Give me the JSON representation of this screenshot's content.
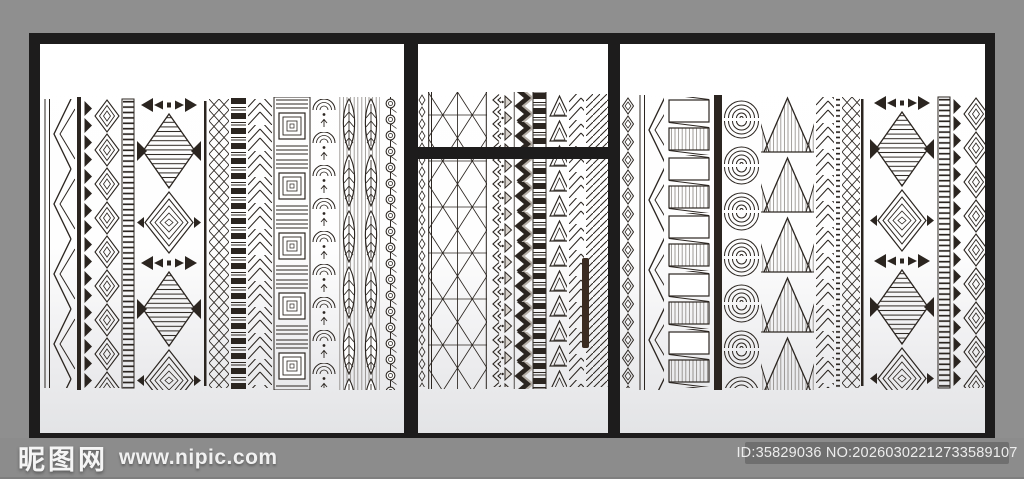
{
  "scene": {
    "description": "Stock-image preview of a black-framed three-panel glass sliding-door partition decorated with hand-drawn black and white tribal / ethnic pattern stripes, shown against a gray studio background with watermarks.",
    "panels": [
      {
        "name": "left-panel",
        "motifs": [
          "zigzag lattice",
          "sawtooth triangles",
          "nested chevron diamonds",
          "rung ladder",
          "diamond and bowtie totem",
          "crosshatch",
          "black rung ladder",
          "herringbone",
          "spiral squares",
          "scallop lace",
          "veined leaves",
          "bead chain"
        ]
      },
      {
        "name": "middle-panel",
        "motifs": [
          "diamond chain",
          "triangle net mesh",
          "chevron arrows",
          "dotted triangles",
          "bold zigzag ribbon",
          "black rung ladder",
          "hollow triangles",
          "herringbone",
          "diagonal hatch"
        ],
        "hardware": [
          "horizontal crossbar",
          "door handle"
        ]
      },
      {
        "name": "right-panel",
        "motifs": [
          "diamond chain",
          "zigzag lattice",
          "hatched rectangle ladder",
          "solid black bar",
          "fingerprint arcs",
          "hatched mountains",
          "herringbone fans",
          "rung ladder",
          "crosshatch",
          "diamond and bowtie totem",
          "rung ladder",
          "sawtooth triangles",
          "nested chevron diamonds"
        ]
      }
    ]
  },
  "watermark": {
    "site_name": "昵图网",
    "site_url": "www.nipic.com",
    "image_id": "ID:35829036 NO:20260302212733589107"
  },
  "colors": {
    "background": "#8f8f8f",
    "band": "#8c8c8c",
    "frame": "#1d1c1c",
    "ink": "#2b2520",
    "handle": "#3a2b21",
    "badge_bg": "#6f6f6f",
    "glass_top": "#ffffff",
    "glass_bottom": "#e3e4e6",
    "watermark_text": "#f5f5f5"
  }
}
